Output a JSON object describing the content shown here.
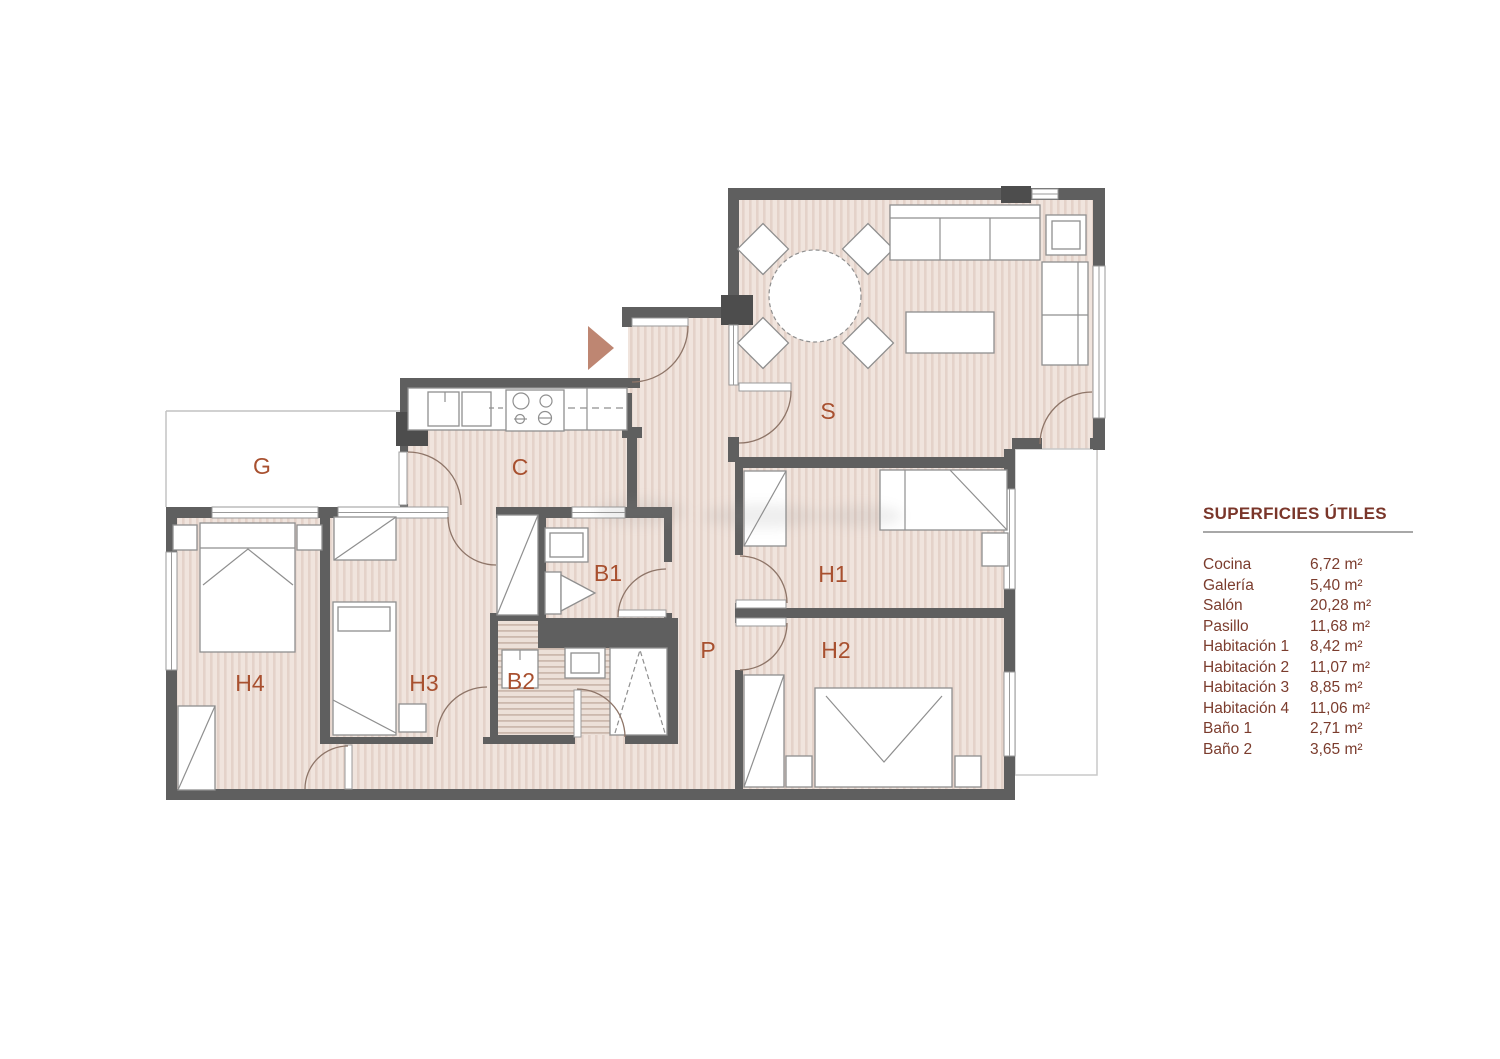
{
  "plan": {
    "entrance_marker": "entrance-arrow",
    "rooms": {
      "galeria": {
        "label": "G"
      },
      "cocina": {
        "label": "C"
      },
      "salon": {
        "label": "S"
      },
      "bano1": {
        "label": "B1"
      },
      "bano2": {
        "label": "B2"
      },
      "pasillo": {
        "label": "P"
      },
      "habitacion1": {
        "label": "H1"
      },
      "habitacion2": {
        "label": "H2"
      },
      "habitacion3": {
        "label": "H3"
      },
      "habitacion4": {
        "label": "H4"
      }
    }
  },
  "legend": {
    "title": "SUPERFICIES ÚTILES",
    "items": [
      {
        "name": "Cocina",
        "area": "6,72 m²"
      },
      {
        "name": "Galería",
        "area": "5,40 m²"
      },
      {
        "name": "Salón",
        "area": "20,28 m²"
      },
      {
        "name": "Pasillo",
        "area": "11,68 m²"
      },
      {
        "name": "Habitación 1",
        "area": "8,42 m²"
      },
      {
        "name": "Habitación 2",
        "area": "11,07 m²"
      },
      {
        "name": "Habitación 3",
        "area": "8,85 m²"
      },
      {
        "name": "Habitación 4",
        "area": "11,06 m²"
      },
      {
        "name": "Baño 1",
        "area": "2,71 m²"
      },
      {
        "name": "Baño 2",
        "area": "3,65 m²"
      }
    ]
  },
  "colors": {
    "wall": "#5f5f5f",
    "wall_dark": "#4d4d4d",
    "floor_base": "#f0e4dd",
    "floor_stripe": "#e4d2c9",
    "room_label": "#a8502f",
    "legend_text": "#7b3c2d",
    "door_arc": "#8e7568",
    "entrance_arrow": "#be8672",
    "furniture_outline": "#8f8f8f"
  }
}
